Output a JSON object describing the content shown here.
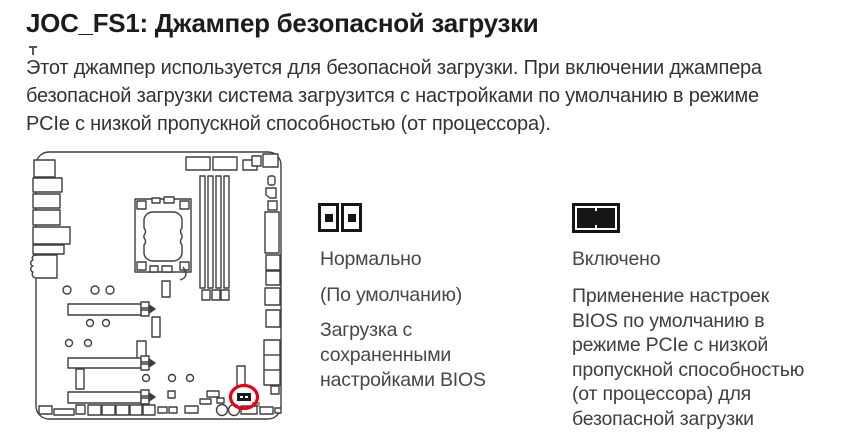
{
  "header": {
    "title": "JOC_FS1: Джампер безопасной загрузки"
  },
  "intro": {
    "text": "Этот джампер используется для безопасной загрузки. При включении джампера\nбезопасной загрузки система загрузится с настройками по умолчанию в режиме\nPCIe с низкой пропускной способностью (от процессора)."
  },
  "diagram": {
    "highlight_color": "#e60012",
    "line_color": "#3f3f3f",
    "icon": "motherboard-diagram"
  },
  "jumper_states": [
    {
      "icon": "jumper-open-icon",
      "label": "Нормально",
      "subtitle": "(По умолчанию)",
      "description": "Загрузка с\nсохраненными\nнастройками BIOS"
    },
    {
      "icon": "jumper-closed-icon",
      "label": "Включено",
      "description": "Применение настроек\nBIOS по умолчанию в\nрежиме PCIe с низкой\nпропускной способностью\n(от процессора) для\nбезопасной загрузки"
    }
  ]
}
